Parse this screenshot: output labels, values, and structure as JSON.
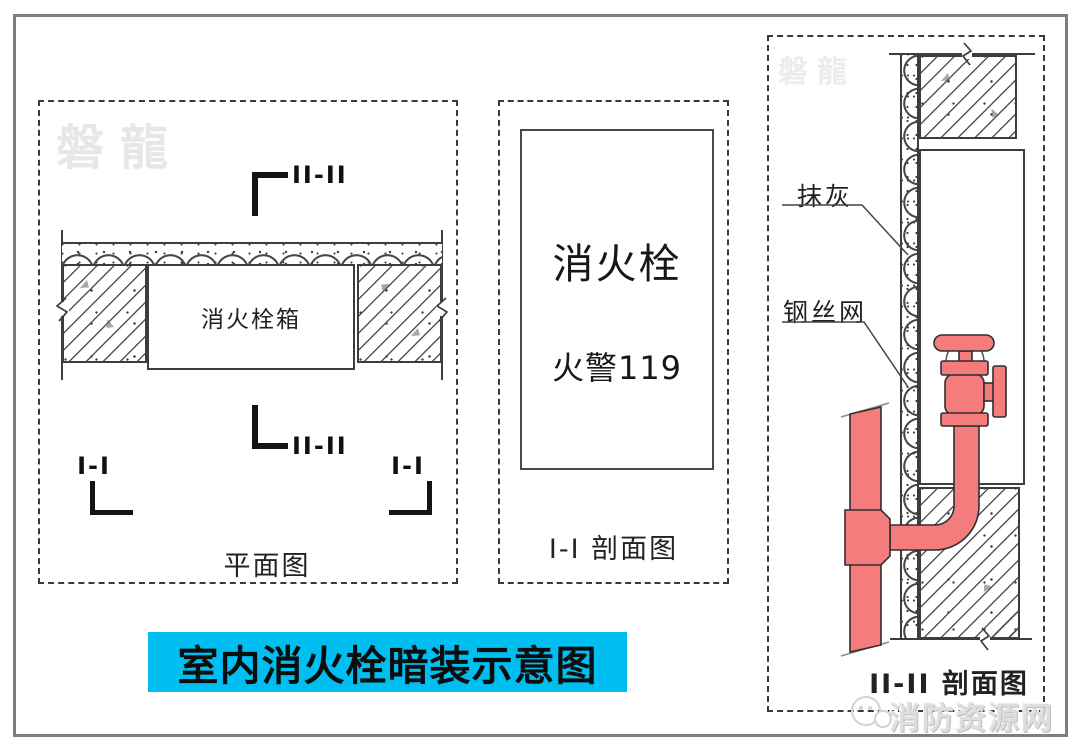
{
  "diagram": {
    "banner": {
      "title": "室内消火栓暗装示意图",
      "bg_color": "#00BEF0"
    },
    "plan_view": {
      "watermark": "磐龍",
      "section_marker_top": "II-II",
      "section_marker_bottom": "II-II",
      "section_marker_left": "I-I",
      "section_marker_right": "I-I",
      "hydrant_box_label": "消火栓箱",
      "caption": "平面图"
    },
    "section_i": {
      "sign_title": "消火栓",
      "sign_subtitle": "火警119",
      "caption": "I-I 剖面图"
    },
    "section_ii": {
      "watermark": "磐龍",
      "callout_plaster": "抹灰",
      "callout_wire_mesh": "钢丝网",
      "caption": "II-II 剖面图",
      "pipe_color": "#F47C7C"
    },
    "site_watermark": "消防资源网"
  }
}
